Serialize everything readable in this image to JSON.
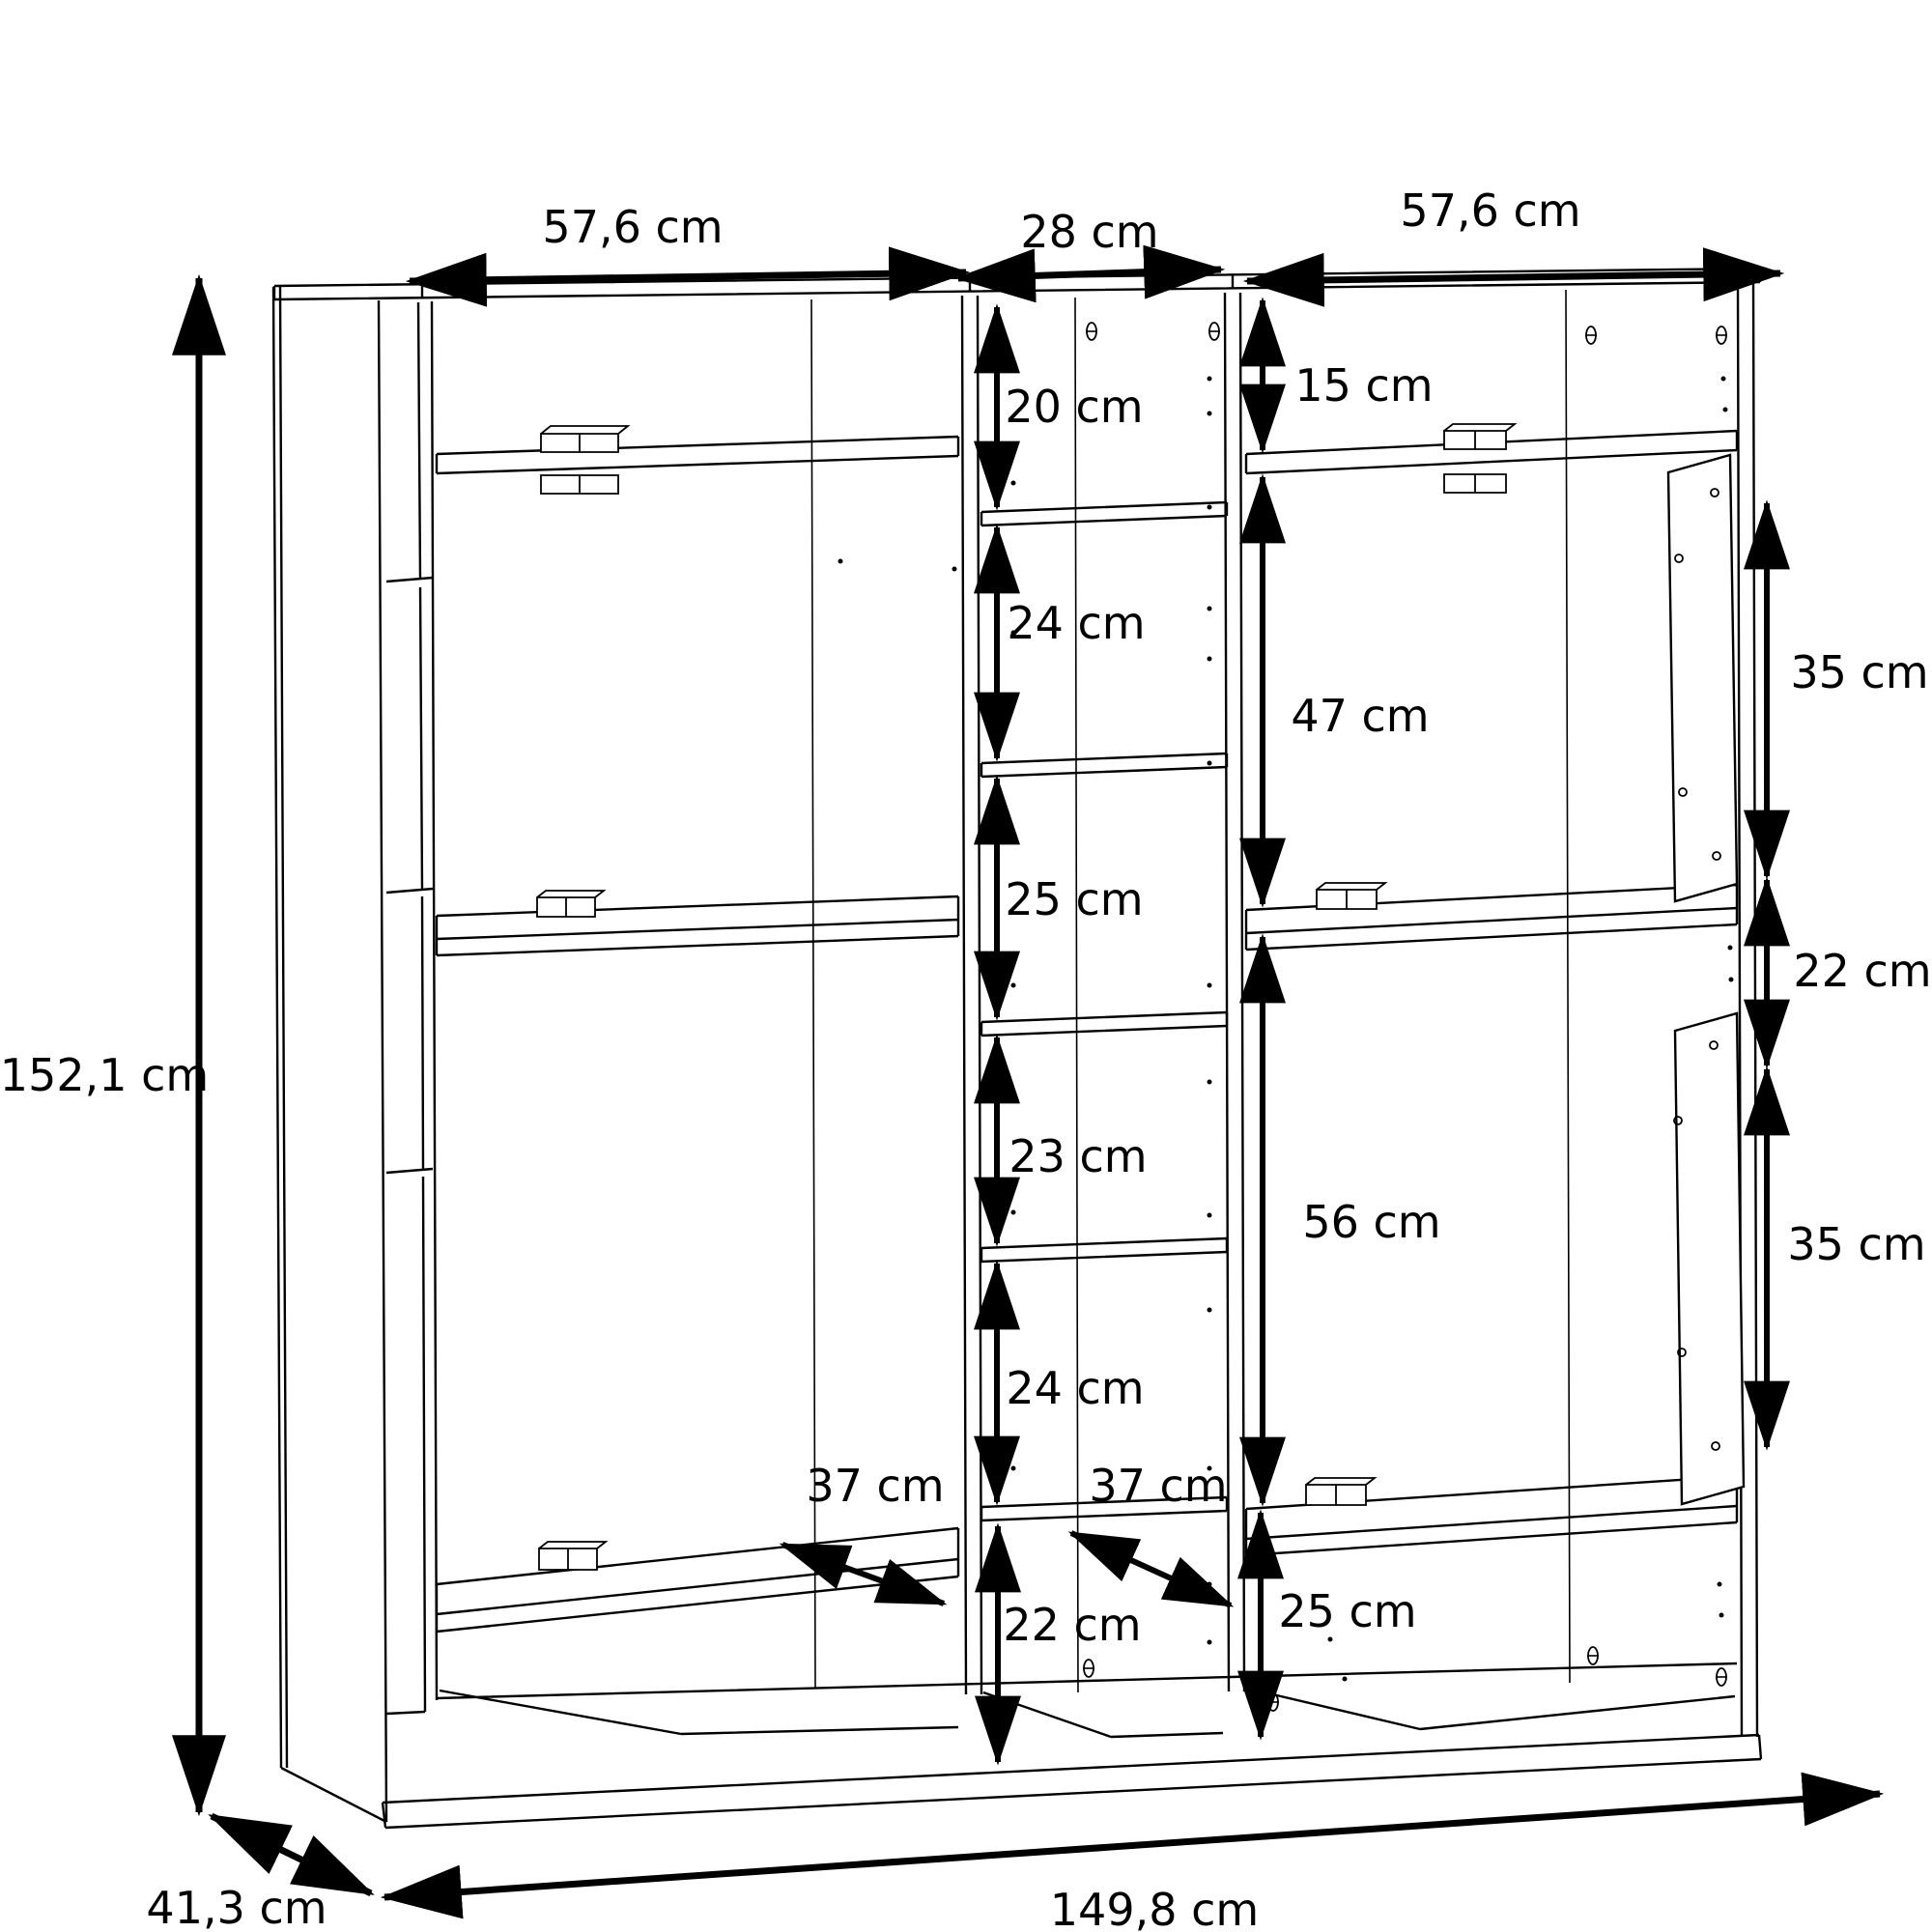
{
  "dimensions": {
    "top": {
      "left_section_width": "57,6 cm",
      "middle_section_width": "28 cm",
      "right_section_width": "57,6 cm"
    },
    "overall": {
      "height": "152,1 cm",
      "depth": "41,3 cm",
      "width": "149,8 cm"
    },
    "middle_column": [
      "20 cm",
      "24 cm",
      "25 cm",
      "23 cm",
      "24 cm",
      "22 cm"
    ],
    "right_section": [
      "15 cm",
      "47 cm",
      "56 cm",
      "25 cm"
    ],
    "right_edge_door": [
      "35 cm",
      "22 cm",
      "35 cm"
    ],
    "shelf_depths": {
      "left": "37 cm",
      "middle": "37 cm"
    },
    "unit": "cm"
  }
}
